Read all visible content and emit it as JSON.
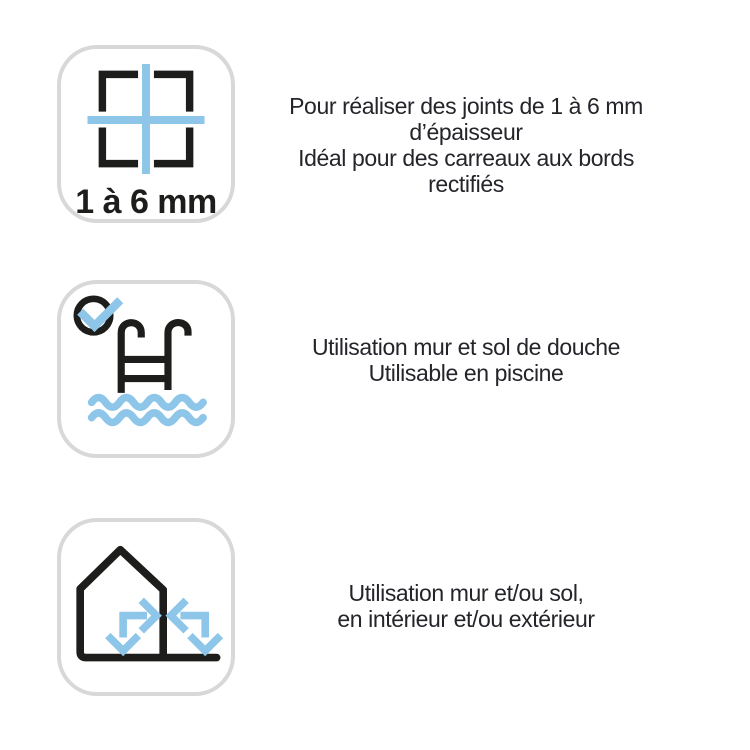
{
  "colors": {
    "background": "#ffffff",
    "icon_ink": "#1d1d1b",
    "icon_blue": "#8dc6e8",
    "card_border": "#d8d8d8",
    "text": "#24242a"
  },
  "features": [
    {
      "icon": "tile-joint-size-icon",
      "badge": "1 à 6 mm",
      "lines": [
        "Pour réaliser des joints de 1 à 6 mm",
        "d’épaisseur",
        "Idéal pour des carreaux aux bords",
        "rectifiés"
      ]
    },
    {
      "icon": "pool-ladder-check-icon",
      "lines": [
        "Utilisation mur et sol de douche",
        "Utilisable en piscine"
      ]
    },
    {
      "icon": "house-indoor-outdoor-icon",
      "lines": [
        "Utilisation mur et/ou sol,",
        "en intérieur et/ou extérieur"
      ]
    }
  ]
}
